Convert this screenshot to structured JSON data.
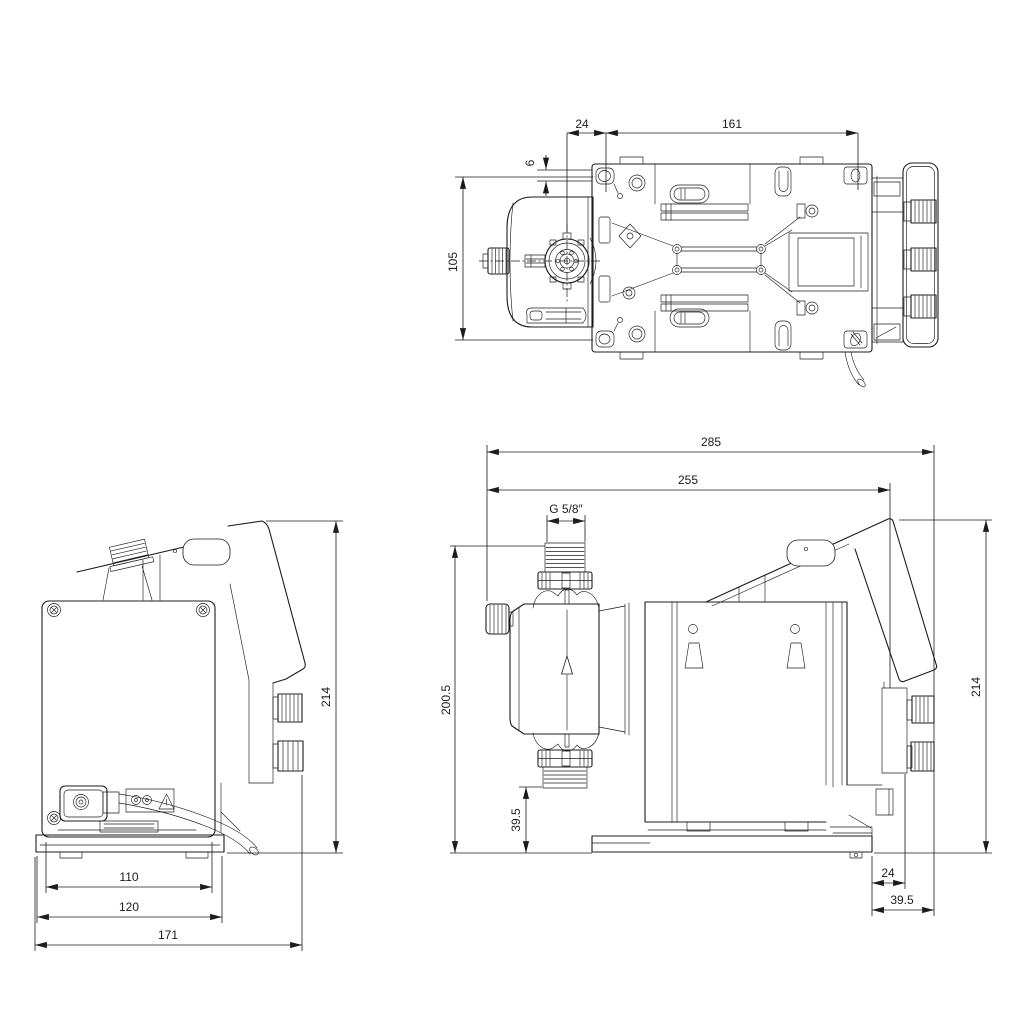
{
  "drawing": {
    "background": "#ffffff",
    "line_color": "#1c1c1c"
  },
  "views": {
    "top": {
      "dim_head_offset": "24",
      "dim_mount_spacing": "161",
      "dim_edge_offset": "6",
      "dim_width": "105"
    },
    "rear": {
      "dim_height": "214",
      "dim_foot_inner": "110",
      "dim_foot_outer": "120",
      "dim_overall_width": "171"
    },
    "side": {
      "dim_overall_length": "285",
      "dim_length": "255",
      "dim_thread": "G 5/8″",
      "dim_inlet_height": "200.5",
      "dim_valve_clearance": "39.5",
      "dim_height": "214",
      "dim_gland_offset": "24",
      "dim_rear_clearance": "39.5"
    }
  }
}
